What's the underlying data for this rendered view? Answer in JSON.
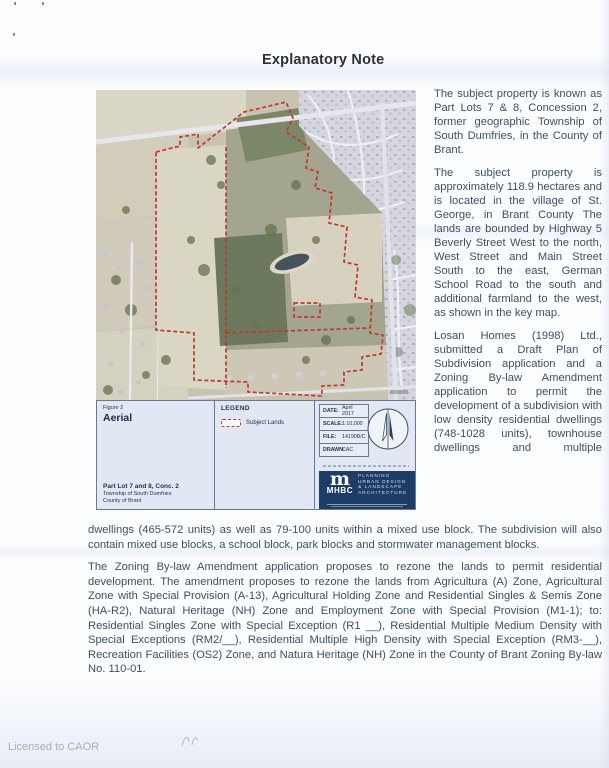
{
  "page": {
    "title": "Explanatory Note",
    "watermark": "Licensed to CAOR"
  },
  "article": {
    "col_para1": "The subject property is known as Part Lots 7 & 8, Concession 2, former geographic Township of South Dumfries, in the County of Brant.",
    "col_para2": "The subject property is approximately 118.9 hectares and is located in the village of St. George, in Brant County  The lands are bounded by Highway 5  Beverly Street West to the north, West Street and Main Street South to the east, German School Road to the south and additional farmland to the west, as shown in the key map.",
    "col_para3": "Losan Homes (1998) Ltd., submitted a Draft Plan of Subdivision application and a Zoning By-law Amendment application to permit the development of a subdivision with low density residential dwellings (748-1028 units), townhouse dwellings and multiple",
    "para4": "dwellings (465-572 units) as well as 79-100 units within a mixed use block. The subdivision will also contain mixed use blocks, a school block, park blocks and stormwater management blocks.",
    "para5": "The Zoning By-law Amendment application proposes to rezone the lands to permit residential development. The amendment proposes to rezone the lands from  Agricultura  (A) Zone, Agricultural Zone with Special Provision (A-13), Agricultural Holding Zone and Residential Singles & Semis Zone (HA-R2), Natural Heritage (NH) Zone and Employment Zone with Special Provision (M1-1); to: Residential Singles Zone with Special Exception (R1 __), Residential Multiple Medium Density with Special Exceptions (RM2/__), Residential Multiple High Density with Special Exception (RM3-__), Recreation Facilities (OS2) Zone, and Natura Heritage (NH) Zone in the County of Brant Zoning By-law No. 110-01."
  },
  "figure": {
    "figure_label": "Figure 2",
    "figure_title": "Aerial",
    "legend_title": "LEGEND",
    "legend_item": "Subject Lands",
    "footer_title": "Part Lot 7 and 8, Conc. 2",
    "footer_line2": "Township of South Dumfries",
    "footer_line3": "County of Brant",
    "meta": [
      {
        "label": "DATE:",
        "value": "April 2017"
      },
      {
        "label": "SCALE:",
        "value": "1:10,000"
      },
      {
        "label": "FILE:",
        "value": "14190B/C"
      },
      {
        "label": "DRAWN:",
        "value": "CAC"
      }
    ],
    "logo": {
      "mark": "m",
      "brand": "MHBC",
      "lines": [
        "PLANNING",
        "URBAN DESIGN",
        "& LANDSCAPE",
        "ARCHITECTURE"
      ]
    },
    "colors": {
      "boundary_red": "#bd3a2e",
      "panel_navy": "#1d3d66",
      "strip_bg": "#e2e8f3"
    }
  }
}
